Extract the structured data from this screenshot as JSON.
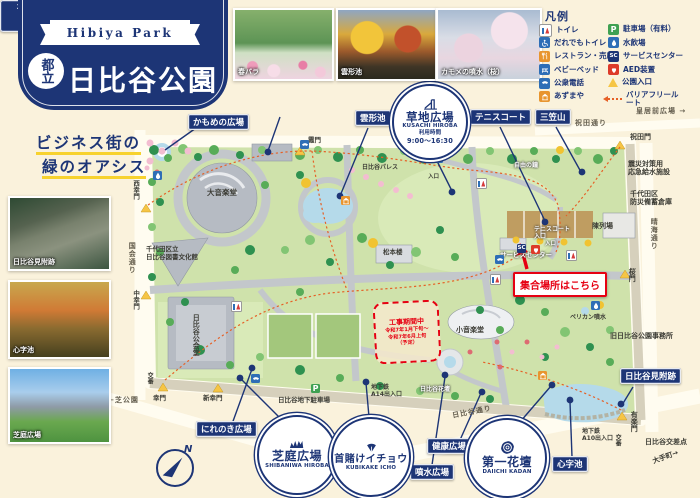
{
  "colors": {
    "navy": "#1d3576",
    "red": "#e60012",
    "cream": "#faf2dc",
    "park_green": "#cfe2ab",
    "water": "#b5daea",
    "route_orange": "#e66026",
    "gate_yellow": "#f6c545"
  },
  "header": {
    "ribbon": "Hibiya Park",
    "badge": "都立",
    "title": "日比谷公園"
  },
  "top_photos": [
    {
      "caption": "春バラ"
    },
    {
      "caption": "雲形池"
    },
    {
      "caption": "カモメの噴水（桜）"
    }
  ],
  "legend": {
    "title": "凡例",
    "glyphs": {
      "parking": "P",
      "service-center": "SC"
    },
    "left": [
      {
        "icon": "toilet",
        "label": "トイレ"
      },
      {
        "icon": "wheelchair",
        "label": "だれでもトイレ"
      },
      {
        "icon": "restaurant",
        "label": "レストラン・売店"
      },
      {
        "icon": "baby-bed",
        "label": "ベビーベッド"
      },
      {
        "icon": "phone",
        "label": "公衆電話"
      },
      {
        "icon": "gazebo",
        "label": "あずまや"
      }
    ],
    "right": [
      {
        "icon": "parking",
        "label": "駐車場（有料）"
      },
      {
        "icon": "water",
        "label": "水飲場"
      },
      {
        "icon": "service-center",
        "label": "サービスセンター"
      },
      {
        "icon": "aed",
        "label": "AED装置"
      },
      {
        "icon": "entrance",
        "label": "公園入口"
      },
      {
        "icon": "barrier",
        "label": "バリアフリールート",
        "wrap": true
      }
    ]
  },
  "sidebar": {
    "slogan": [
      "ビジネス街の",
      "緑のオアシス"
    ],
    "photos": [
      {
        "caption": "日比谷見附跡"
      },
      {
        "caption": "心字池"
      },
      {
        "caption": "芝庭広場"
      }
    ]
  },
  "map": {
    "college": [
      "2F-3F 緑と水の市民カレッジ",
      "（2F ビーチタウン）",
      "1F クリーズコーヒー"
    ],
    "meeting": "集合場所はこちら",
    "construction": [
      "工事期間中",
      "令和7年1月下旬～",
      "令和7年6月上旬",
      "（予定）"
    ],
    "compass": "N",
    "circles": [
      {
        "icon": "playground",
        "lines": [
          "草地広場",
          "KUSACHI HIROBA",
          "利用時間",
          "9:00～16:30"
        ]
      },
      {
        "icon": "lawn",
        "lines": [
          "芝庭広場",
          "SHIBANIWA HIROBA"
        ]
      },
      {
        "icon": "ginkgo-leaf",
        "lines": [
          "首賭けイチョウ",
          "KUBIKAKE ICHO"
        ]
      },
      {
        "icon": "rose",
        "lines": [
          "第一花壇",
          "DAIICHI KADAN"
        ]
      }
    ],
    "boxes": [
      {
        "n": "kamome",
        "t": "かもめの広場",
        "x": 188,
        "y": 114
      },
      {
        "n": "kumogata",
        "t": "雲形池",
        "x": 355,
        "y": 110
      },
      {
        "n": "tennis",
        "t": "テニスコート",
        "x": 470,
        "y": 109
      },
      {
        "n": "mikasa",
        "t": "三笠山",
        "x": 535,
        "y": 109
      },
      {
        "n": "nirenoki",
        "t": "にれのき広場",
        "x": 196,
        "y": 421
      },
      {
        "n": "kenko",
        "t": "健康広場",
        "x": 427,
        "y": 438
      },
      {
        "n": "funsui",
        "t": "噴水広場",
        "x": 410,
        "y": 464
      },
      {
        "n": "shinji",
        "t": "心字池",
        "x": 552,
        "y": 456
      },
      {
        "n": "mitsuke",
        "t": "日比谷見附跡",
        "x": 620,
        "y": 368
      }
    ],
    "texts": [
      {
        "t": "祝田通り",
        "x": 575,
        "y": 119,
        "c": "street"
      },
      {
        "t": "皇居前広場 →",
        "x": 636,
        "y": 107,
        "s": 7,
        "c": "street"
      },
      {
        "t": "祝田門",
        "x": 630,
        "y": 133,
        "s": 7
      },
      {
        "t": "晴海通り",
        "x": 650,
        "y": 218,
        "c": "street",
        "v": 1
      },
      {
        "t": "震災対策用\n応急給水施設",
        "x": 628,
        "y": 160,
        "s": 7
      },
      {
        "t": "千代田区\n防災備蓄倉庫",
        "x": 630,
        "y": 190,
        "s": 7
      },
      {
        "t": "陳列場",
        "x": 592,
        "y": 222,
        "s": 7
      },
      {
        "t": "旧日比谷公園事務所",
        "x": 610,
        "y": 332,
        "s": 7
      },
      {
        "t": "桜門",
        "x": 628,
        "y": 268,
        "v": 1,
        "s": 7
      },
      {
        "t": "有楽門",
        "x": 630,
        "y": 411,
        "v": 1,
        "s": 7
      },
      {
        "t": "日比谷交差点",
        "x": 645,
        "y": 438,
        "s": 7
      },
      {
        "t": "大手町→",
        "x": 652,
        "y": 453,
        "s": 7,
        "r": -20
      },
      {
        "t": "地下鉄\nA10出入口",
        "x": 582,
        "y": 428,
        "s": 6
      },
      {
        "t": "交番",
        "x": 614,
        "y": 434,
        "v": 1,
        "s": 6
      },
      {
        "t": "地下鉄\nA14出入口",
        "x": 371,
        "y": 384,
        "s": 6
      },
      {
        "t": "日比谷地下駐車場",
        "x": 278,
        "y": 397,
        "s": 6.5
      },
      {
        "t": "日比谷通り",
        "x": 452,
        "y": 408,
        "c": "street",
        "r": -11
      },
      {
        "t": "国会通り",
        "x": 128,
        "y": 242,
        "c": "street",
        "v": 1
      },
      {
        "t": "西幸門",
        "x": 131,
        "y": 180,
        "v": 1,
        "s": 6.5
      },
      {
        "t": "中幸門",
        "x": 131,
        "y": 290,
        "v": 1,
        "s": 6.5
      },
      {
        "t": "幸門",
        "x": 153,
        "y": 395,
        "s": 6.5
      },
      {
        "t": "新幸門",
        "x": 203,
        "y": 395,
        "s": 6.5
      },
      {
        "t": "←芝公園",
        "x": 108,
        "y": 396,
        "s": 7,
        "c": "street"
      },
      {
        "t": "交番",
        "x": 146,
        "y": 372,
        "v": 1,
        "s": 6
      },
      {
        "t": "霞門",
        "x": 308,
        "y": 137,
        "s": 6.5
      },
      {
        "t": "日比谷パレス",
        "x": 362,
        "y": 164,
        "s": 6
      },
      {
        "t": "自由の鐘",
        "x": 514,
        "y": 162,
        "s": 6,
        "w": 1
      },
      {
        "t": "ペリカン噴水",
        "x": 570,
        "y": 314,
        "s": 6
      },
      {
        "t": "松本楼",
        "x": 383,
        "y": 249,
        "s": 6.5
      },
      {
        "t": "大音楽堂",
        "x": 207,
        "y": 189,
        "s": 7.5
      },
      {
        "t": "千代田区立\n日比谷図書文化館",
        "x": 146,
        "y": 246,
        "s": 6.5
      },
      {
        "t": "日比谷公会堂",
        "x": 192,
        "y": 314,
        "v": 1,
        "s": 7
      },
      {
        "t": "小音楽堂",
        "x": 456,
        "y": 326,
        "s": 7
      },
      {
        "t": "サービスセンター",
        "x": 500,
        "y": 252,
        "s": 6.5,
        "w": 1
      },
      {
        "t": "テニスコート\n入口",
        "x": 534,
        "y": 226,
        "s": 6,
        "w": 1
      },
      {
        "t": "日比谷花壇",
        "x": 420,
        "y": 386,
        "s": 6,
        "w": 1
      },
      {
        "t": "入口",
        "x": 428,
        "y": 174,
        "s": 5.5
      },
      {
        "t": "入口",
        "x": 545,
        "y": 241,
        "s": 5.5,
        "w": 1
      }
    ]
  }
}
